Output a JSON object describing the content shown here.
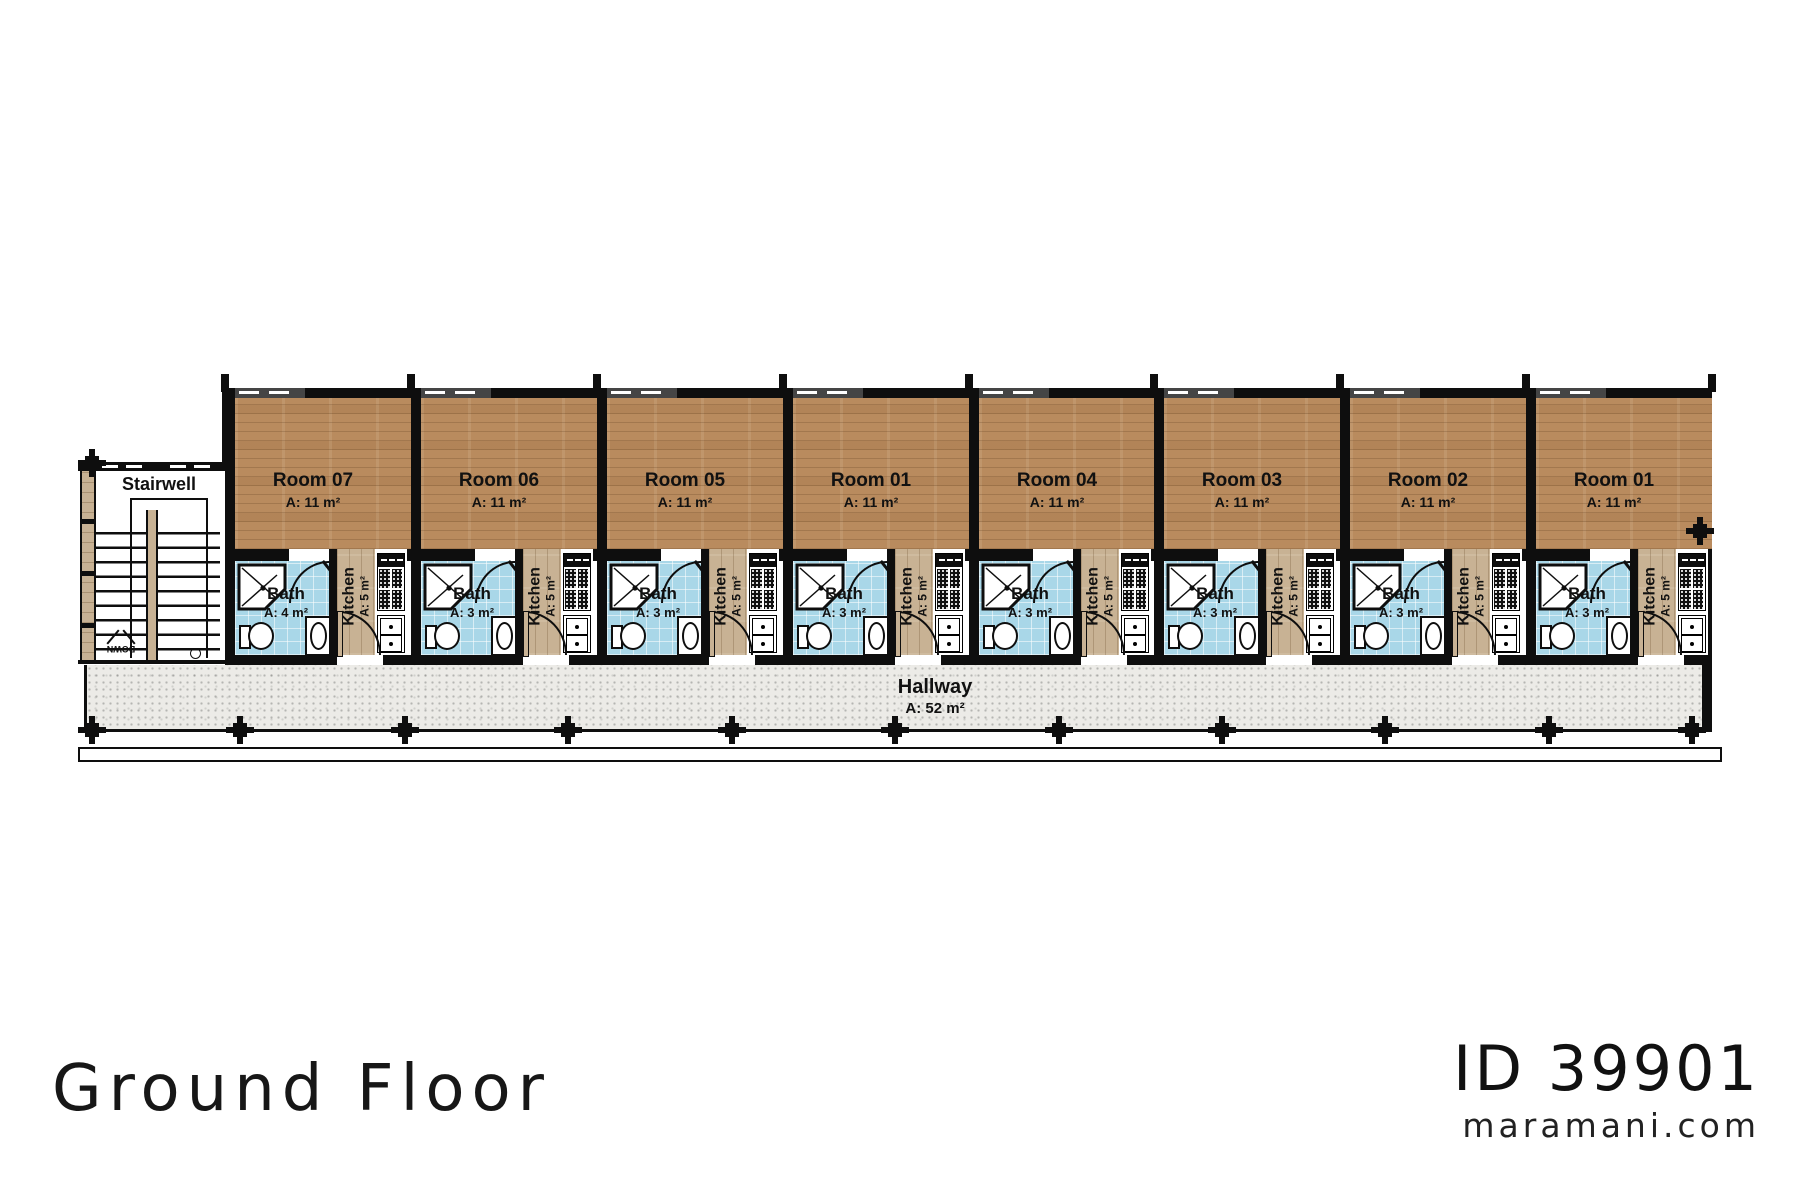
{
  "floor_title": "Ground Floor",
  "plan_id": "ID 39901",
  "website": "maramani.com",
  "stairwell": {
    "label": "Stairwell",
    "down_label": "DOWN"
  },
  "hallway": {
    "label": "Hallway",
    "area": "A: 52 m²"
  },
  "units": [
    {
      "room_label": "Room 07",
      "room_area": "A: 11 m²",
      "bath_label": "Bath",
      "bath_area": "A: 4 m²",
      "kitchen_label": "Kitchen",
      "kitchen_area": "A: 5 m²"
    },
    {
      "room_label": "Room 06",
      "room_area": "A: 11 m²",
      "bath_label": "Bath",
      "bath_area": "A: 3 m²",
      "kitchen_label": "Kitchen",
      "kitchen_area": "A: 5 m²"
    },
    {
      "room_label": "Room 05",
      "room_area": "A: 11 m²",
      "bath_label": "Bath",
      "bath_area": "A: 3 m²",
      "kitchen_label": "Kitchen",
      "kitchen_area": "A: 5 m²"
    },
    {
      "room_label": "Room 01",
      "room_area": "A: 11 m²",
      "bath_label": "Bath",
      "bath_area": "A: 3 m²",
      "kitchen_label": "Kitchen",
      "kitchen_area": "A: 5 m²"
    },
    {
      "room_label": "Room 04",
      "room_area": "A: 11 m²",
      "bath_label": "Bath",
      "bath_area": "A: 3 m²",
      "kitchen_label": "Kitchen",
      "kitchen_area": "A: 5 m²"
    },
    {
      "room_label": "Room 03",
      "room_area": "A: 11 m²",
      "bath_label": "Bath",
      "bath_area": "A: 3 m²",
      "kitchen_label": "Kitchen",
      "kitchen_area": "A: 5 m²"
    },
    {
      "room_label": "Room 02",
      "room_area": "A: 11 m²",
      "bath_label": "Bath",
      "bath_area": "A: 3 m²",
      "kitchen_label": "Kitchen",
      "kitchen_area": "A: 5 m²"
    },
    {
      "room_label": "Room 01",
      "room_area": "A: 11 m²",
      "bath_label": "Bath",
      "bath_area": "A: 3 m²",
      "kitchen_label": "Kitchen",
      "kitchen_area": "A: 5 m²"
    }
  ],
  "colors": {
    "wall": "#0e0e0e",
    "wood_room": "#b98b5e",
    "wood_kitchen": "#c8b294",
    "tile_bath": "#a9d7e8",
    "hallway_floor": "#ecebe7"
  }
}
